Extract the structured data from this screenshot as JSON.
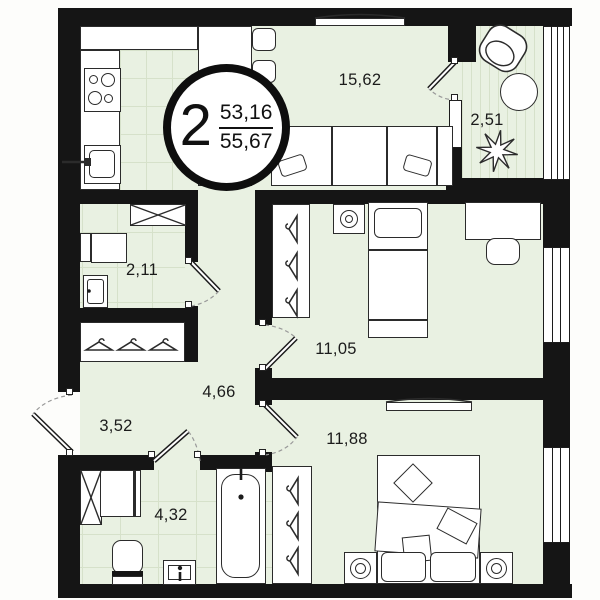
{
  "badge": {
    "room_count": "2",
    "area_top": "53,16",
    "area_bottom": "55,67"
  },
  "room_labels": {
    "living": "15,62",
    "balcony": "2,51",
    "laundry": "2,11",
    "bedroom1": "11,05",
    "hallway": "4,66",
    "hall": "3,52",
    "bedroom2": "11,88",
    "bathroom": "4,32"
  },
  "colors": {
    "floor": "#e9f1e2",
    "wall": "#151515",
    "line": "#2b2b2b",
    "tile": "#d6e1ca"
  }
}
